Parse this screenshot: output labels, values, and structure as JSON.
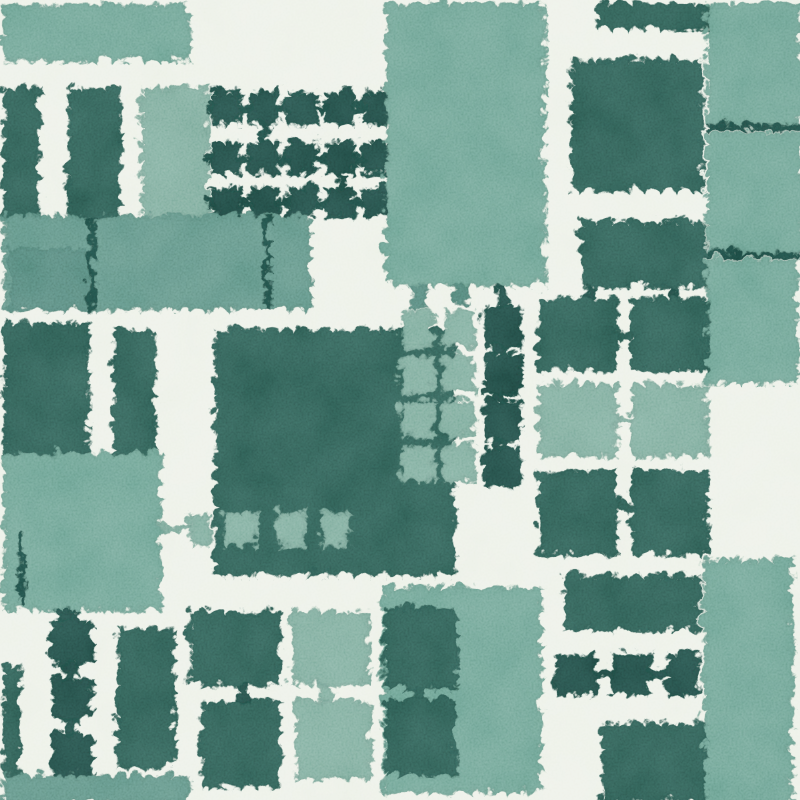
{
  "scene": {
    "type": "abstract-watercolor-block-pattern",
    "width": 800,
    "height": 800,
    "background": "#edf1e8"
  },
  "palette": {
    "paper": "#edf1e8",
    "tealA": "#6da293",
    "tealB": "#7cab9c",
    "tealC": "#5f9285",
    "tealD": "#538579",
    "green": "#2e5c53",
    "greenDark": "#214b45"
  },
  "shapes": [
    {
      "name": "top-band",
      "x": 0,
      "y": 0,
      "w": 186,
      "h": 58,
      "c": "tealA"
    },
    {
      "name": "teal-col-top",
      "x": 138,
      "y": 84,
      "w": 68,
      "h": 130,
      "c": "tealB"
    },
    {
      "name": "dark-col-a",
      "x": 0,
      "y": 84,
      "w": 38,
      "h": 130,
      "c": "green"
    },
    {
      "name": "dark-col-b",
      "x": 64,
      "y": 84,
      "w": 54,
      "h": 130,
      "c": "green"
    },
    {
      "name": "grid-a-sq",
      "x": 208,
      "y": 88,
      "w": 30,
      "h": 33,
      "c": "greenDark"
    },
    {
      "name": "grid-a-sq",
      "x": 246,
      "y": 88,
      "w": 30,
      "h": 33,
      "c": "greenDark"
    },
    {
      "name": "grid-a-sq",
      "x": 284,
      "y": 88,
      "w": 30,
      "h": 33,
      "c": "greenDark"
    },
    {
      "name": "grid-a-sq",
      "x": 322,
      "y": 88,
      "w": 30,
      "h": 33,
      "c": "greenDark"
    },
    {
      "name": "grid-a-sq",
      "x": 360,
      "y": 88,
      "w": 30,
      "h": 33,
      "c": "greenDark"
    },
    {
      "name": "grid-a-sq",
      "x": 208,
      "y": 138,
      "w": 30,
      "h": 34,
      "c": "greenDark"
    },
    {
      "name": "grid-a-sq",
      "x": 246,
      "y": 138,
      "w": 30,
      "h": 34,
      "c": "greenDark"
    },
    {
      "name": "grid-a-sq",
      "x": 284,
      "y": 138,
      "w": 30,
      "h": 34,
      "c": "greenDark"
    },
    {
      "name": "grid-a-sq",
      "x": 322,
      "y": 138,
      "w": 30,
      "h": 34,
      "c": "greenDark"
    },
    {
      "name": "grid-a-sq",
      "x": 360,
      "y": 138,
      "w": 30,
      "h": 34,
      "c": "greenDark"
    },
    {
      "name": "grid-a-sq",
      "x": 208,
      "y": 184,
      "w": 30,
      "h": 30,
      "c": "greenDark"
    },
    {
      "name": "grid-a-sq",
      "x": 246,
      "y": 184,
      "w": 30,
      "h": 30,
      "c": "greenDark"
    },
    {
      "name": "grid-a-sq",
      "x": 284,
      "y": 184,
      "w": 30,
      "h": 30,
      "c": "greenDark"
    },
    {
      "name": "grid-a-sq",
      "x": 322,
      "y": 184,
      "w": 30,
      "h": 30,
      "c": "greenDark"
    },
    {
      "name": "grid-a-sq",
      "x": 360,
      "y": 184,
      "w": 30,
      "h": 30,
      "c": "greenDark"
    },
    {
      "name": "grid-a-link",
      "x": 238,
      "y": 101,
      "w": 8,
      "h": 9,
      "c": "greenDark"
    },
    {
      "name": "grid-a-link",
      "x": 276,
      "y": 101,
      "w": 8,
      "h": 9,
      "c": "greenDark"
    },
    {
      "name": "grid-a-link",
      "x": 314,
      "y": 101,
      "w": 8,
      "h": 9,
      "c": "greenDark"
    },
    {
      "name": "grid-a-link",
      "x": 352,
      "y": 101,
      "w": 8,
      "h": 9,
      "c": "greenDark"
    },
    {
      "name": "grid-a-link",
      "x": 238,
      "y": 152,
      "w": 8,
      "h": 9,
      "c": "greenDark"
    },
    {
      "name": "grid-a-link",
      "x": 276,
      "y": 152,
      "w": 8,
      "h": 9,
      "c": "greenDark"
    },
    {
      "name": "grid-a-link",
      "x": 314,
      "y": 152,
      "w": 8,
      "h": 9,
      "c": "greenDark"
    },
    {
      "name": "grid-a-link",
      "x": 352,
      "y": 152,
      "w": 8,
      "h": 9,
      "c": "greenDark"
    },
    {
      "name": "grid-a-link",
      "x": 238,
      "y": 195,
      "w": 8,
      "h": 9,
      "c": "greenDark"
    },
    {
      "name": "grid-a-link",
      "x": 276,
      "y": 195,
      "w": 8,
      "h": 9,
      "c": "greenDark"
    },
    {
      "name": "grid-a-link",
      "x": 314,
      "y": 195,
      "w": 8,
      "h": 9,
      "c": "greenDark"
    },
    {
      "name": "grid-a-link",
      "x": 352,
      "y": 195,
      "w": 8,
      "h": 9,
      "c": "greenDark"
    },
    {
      "name": "grid-a-stub",
      "x": 202,
      "y": 100,
      "w": 8,
      "h": 10,
      "c": "greenDark"
    },
    {
      "name": "grid-a-stub",
      "x": 202,
      "y": 150,
      "w": 8,
      "h": 10,
      "c": "greenDark"
    },
    {
      "name": "grid-a-stub",
      "x": 202,
      "y": 194,
      "w": 8,
      "h": 10,
      "c": "greenDark"
    },
    {
      "name": "grid-a-vlink",
      "x": 258,
      "y": 121,
      "w": 8,
      "h": 17,
      "c": "greenDark"
    },
    {
      "name": "grid-a-vlink",
      "x": 334,
      "y": 172,
      "w": 8,
      "h": 12,
      "c": "greenDark"
    },
    {
      "name": "band-main",
      "x": 0,
      "y": 212,
      "w": 308,
      "h": 95,
      "c": "tealC"
    },
    {
      "name": "band-sub",
      "x": 6,
      "y": 246,
      "w": 84,
      "h": 61,
      "c": "tealD"
    },
    {
      "name": "wire-a",
      "x": 86,
      "y": 212,
      "w": 6,
      "h": 95,
      "c": "greenDark"
    },
    {
      "name": "wire-b",
      "x": 261,
      "y": 214,
      "w": 6,
      "h": 93,
      "c": "greenDark"
    },
    {
      "name": "top-column",
      "x": 382,
      "y": 0,
      "w": 160,
      "h": 282,
      "c": "tealA"
    },
    {
      "name": "column-stub",
      "x": 408,
      "y": 281,
      "w": 16,
      "h": 26,
      "c": "tealD"
    },
    {
      "name": "column-stub",
      "x": 450,
      "y": 281,
      "w": 14,
      "h": 22,
      "c": "tealD"
    },
    {
      "name": "column-stub-dark",
      "x": 492,
      "y": 281,
      "w": 14,
      "h": 24,
      "c": "greenDark"
    },
    {
      "name": "top-dark-rect",
      "x": 595,
      "y": 0,
      "w": 108,
      "h": 26,
      "c": "green"
    },
    {
      "name": "top-dark-square",
      "x": 568,
      "y": 56,
      "w": 132,
      "h": 132,
      "c": "green"
    },
    {
      "name": "right-col-seg",
      "x": 703,
      "y": 0,
      "w": 97,
      "h": 121,
      "c": "tealA"
    },
    {
      "name": "right-col-seg",
      "x": 703,
      "y": 128,
      "w": 97,
      "h": 121,
      "c": "tealA"
    },
    {
      "name": "right-col-seam",
      "x": 703,
      "y": 120,
      "w": 97,
      "h": 7,
      "c": "greenDark"
    },
    {
      "name": "right-col-seg",
      "x": 702,
      "y": 256,
      "w": 94,
      "h": 124,
      "c": "tealA"
    },
    {
      "name": "right-col-seam",
      "x": 702,
      "y": 249,
      "w": 94,
      "h": 6,
      "c": "greenDark"
    },
    {
      "name": "mid-dark-rect",
      "x": 578,
      "y": 218,
      "w": 124,
      "h": 66,
      "c": "green"
    },
    {
      "name": "mid-rect-stub",
      "x": 582,
      "y": 284,
      "w": 10,
      "h": 12,
      "c": "greenDark"
    },
    {
      "name": "mid-rect-stub",
      "x": 664,
      "y": 284,
      "w": 10,
      "h": 12,
      "c": "greenDark"
    },
    {
      "name": "grid-b-sq",
      "x": 535,
      "y": 295,
      "w": 80,
      "h": 73,
      "c": "green"
    },
    {
      "name": "grid-b-sq",
      "x": 628,
      "y": 295,
      "w": 77,
      "h": 73,
      "c": "green"
    },
    {
      "name": "grid-b-sq",
      "x": 535,
      "y": 381,
      "w": 80,
      "h": 73,
      "c": "tealB"
    },
    {
      "name": "grid-b-sq",
      "x": 628,
      "y": 381,
      "w": 77,
      "h": 73,
      "c": "tealB"
    },
    {
      "name": "grid-b-sq",
      "x": 535,
      "y": 467,
      "w": 80,
      "h": 85,
      "c": "green"
    },
    {
      "name": "grid-b-sq",
      "x": 628,
      "y": 467,
      "w": 77,
      "h": 85,
      "c": "green"
    },
    {
      "name": "grid-b-link",
      "x": 615,
      "y": 327,
      "w": 13,
      "h": 9,
      "c": "green"
    },
    {
      "name": "grid-b-link",
      "x": 615,
      "y": 413,
      "w": 13,
      "h": 9,
      "c": "tealB"
    },
    {
      "name": "grid-b-link",
      "x": 615,
      "y": 499,
      "w": 13,
      "h": 9,
      "c": "green"
    },
    {
      "name": "center-block",
      "x": 212,
      "y": 326,
      "w": 240,
      "h": 246,
      "c": "green"
    },
    {
      "name": "light-col-sq",
      "x": 398,
      "y": 308,
      "w": 34,
      "h": 37,
      "c": "tealB"
    },
    {
      "name": "light-col-sq",
      "x": 398,
      "y": 352,
      "w": 34,
      "h": 38,
      "c": "tealB"
    },
    {
      "name": "light-col-sq",
      "x": 398,
      "y": 397,
      "w": 34,
      "h": 37,
      "c": "tealB"
    },
    {
      "name": "light-col-sq",
      "x": 398,
      "y": 441,
      "w": 34,
      "h": 37,
      "c": "tealB"
    },
    {
      "name": "light-col-sq",
      "x": 440,
      "y": 308,
      "w": 32,
      "h": 37,
      "c": "tealB"
    },
    {
      "name": "light-col-sq",
      "x": 440,
      "y": 352,
      "w": 32,
      "h": 38,
      "c": "tealB"
    },
    {
      "name": "light-col-sq",
      "x": 440,
      "y": 397,
      "w": 32,
      "h": 37,
      "c": "tealB"
    },
    {
      "name": "light-col-sq",
      "x": 440,
      "y": 441,
      "w": 32,
      "h": 37,
      "c": "tealB"
    },
    {
      "name": "chain-col-sq",
      "x": 480,
      "y": 303,
      "w": 38,
      "h": 42,
      "c": "greenDark"
    },
    {
      "name": "chain-col-sq",
      "x": 480,
      "y": 350,
      "w": 38,
      "h": 42,
      "c": "greenDark"
    },
    {
      "name": "chain-col-sq",
      "x": 480,
      "y": 396,
      "w": 38,
      "h": 42,
      "c": "greenDark"
    },
    {
      "name": "chain-col-sq",
      "x": 480,
      "y": 443,
      "w": 38,
      "h": 40,
      "c": "greenDark"
    },
    {
      "name": "chain-col-vlink",
      "x": 493,
      "y": 341,
      "w": 10,
      "h": 13,
      "c": "greenDark"
    },
    {
      "name": "chain-col-vlink",
      "x": 493,
      "y": 388,
      "w": 10,
      "h": 12,
      "c": "greenDark"
    },
    {
      "name": "chain-col-vlink",
      "x": 493,
      "y": 434,
      "w": 10,
      "h": 13,
      "c": "greenDark"
    },
    {
      "name": "block-chain-sq",
      "x": 220,
      "y": 508,
      "w": 34,
      "h": 36,
      "c": "tealB"
    },
    {
      "name": "block-chain-sq",
      "x": 274,
      "y": 508,
      "w": 28,
      "h": 36,
      "c": "tealB"
    },
    {
      "name": "block-chain-sq",
      "x": 318,
      "y": 508,
      "w": 28,
      "h": 36,
      "c": "tealB"
    },
    {
      "name": "block-chain-sq",
      "x": 185,
      "y": 510,
      "w": 24,
      "h": 31,
      "c": "tealB"
    },
    {
      "name": "block-chain-line",
      "x": 156,
      "y": 522,
      "w": 30,
      "h": 7,
      "c": "tealB"
    },
    {
      "name": "col-a-mid",
      "x": 0,
      "y": 320,
      "w": 86,
      "h": 132,
      "c": "green"
    },
    {
      "name": "col-b-mid",
      "x": 110,
      "y": 326,
      "w": 42,
      "h": 127,
      "c": "green"
    },
    {
      "name": "left-teal-block",
      "x": 0,
      "y": 450,
      "w": 158,
      "h": 157,
      "c": "tealA"
    },
    {
      "name": "left-thin-line",
      "x": 16,
      "y": 532,
      "w": 6,
      "h": 72,
      "c": "greenDark"
    },
    {
      "name": "chain-left-sq",
      "x": 48,
      "y": 618,
      "w": 42,
      "h": 44,
      "c": "greenDark"
    },
    {
      "name": "chain-left-sq",
      "x": 48,
      "y": 674,
      "w": 42,
      "h": 42,
      "c": "greenDark"
    },
    {
      "name": "chain-left-sq",
      "x": 48,
      "y": 730,
      "w": 42,
      "h": 44,
      "c": "greenDark"
    },
    {
      "name": "chain-left-vlink",
      "x": 61,
      "y": 660,
      "w": 13,
      "h": 16,
      "c": "greenDark"
    },
    {
      "name": "chain-left-vlink",
      "x": 61,
      "y": 714,
      "w": 13,
      "h": 18,
      "c": "greenDark"
    },
    {
      "name": "chain-left-stub",
      "x": 54,
      "y": 604,
      "w": 20,
      "h": 16,
      "c": "greenDark"
    },
    {
      "name": "left-strip",
      "x": 0,
      "y": 662,
      "w": 18,
      "h": 114,
      "c": "green"
    },
    {
      "name": "tall-dark-rect",
      "x": 114,
      "y": 626,
      "w": 58,
      "h": 139,
      "c": "green"
    },
    {
      "name": "bottom-band",
      "x": 0,
      "y": 772,
      "w": 186,
      "h": 28,
      "c": "tealC"
    },
    {
      "name": "bottom-dark-rect",
      "x": 186,
      "y": 608,
      "w": 92,
      "h": 74,
      "c": "green"
    },
    {
      "name": "bottom-dark-rect",
      "x": 198,
      "y": 698,
      "w": 80,
      "h": 86,
      "c": "green"
    },
    {
      "name": "bottom-dark-vlink",
      "x": 234,
      "y": 681,
      "w": 14,
      "h": 18,
      "c": "greenDark"
    },
    {
      "name": "bottom-light-sq",
      "x": 288,
      "y": 608,
      "w": 78,
      "h": 74,
      "c": "tealB"
    },
    {
      "name": "bottom-light-sq",
      "x": 292,
      "y": 698,
      "w": 76,
      "h": 78,
      "c": "tealB"
    },
    {
      "name": "bottom-light-vlink",
      "x": 314,
      "y": 681,
      "w": 16,
      "h": 18,
      "c": "tealB"
    },
    {
      "name": "bottom-teal-bg",
      "x": 379,
      "y": 584,
      "w": 160,
      "h": 206,
      "c": "tealA"
    },
    {
      "name": "bottom-teal-dark-sq",
      "x": 381,
      "y": 604,
      "w": 74,
      "h": 82,
      "c": "green"
    },
    {
      "name": "bottom-teal-dark-sq",
      "x": 381,
      "y": 696,
      "w": 72,
      "h": 76,
      "c": "green"
    },
    {
      "name": "bottom-teal-dark-vlink",
      "x": 408,
      "y": 685,
      "w": 16,
      "h": 12,
      "c": "green"
    },
    {
      "name": "br-bar",
      "x": 560,
      "y": 572,
      "w": 138,
      "h": 56,
      "c": "green"
    },
    {
      "name": "br-chain-sq",
      "x": 552,
      "y": 650,
      "w": 42,
      "h": 42,
      "c": "greenDark"
    },
    {
      "name": "br-chain-sq",
      "x": 608,
      "y": 650,
      "w": 40,
      "h": 42,
      "c": "greenDark"
    },
    {
      "name": "br-chain-sq",
      "x": 664,
      "y": 650,
      "w": 32,
      "h": 42,
      "c": "greenDark"
    },
    {
      "name": "br-chain-hlink",
      "x": 592,
      "y": 666,
      "w": 18,
      "h": 10,
      "c": "greenDark"
    },
    {
      "name": "br-chain-hlink",
      "x": 646,
      "y": 666,
      "w": 20,
      "h": 10,
      "c": "greenDark"
    },
    {
      "name": "br-teal-col",
      "x": 700,
      "y": 556,
      "w": 90,
      "h": 244,
      "c": "tealA"
    },
    {
      "name": "br-dark-block",
      "x": 598,
      "y": 720,
      "w": 104,
      "h": 80,
      "c": "green"
    }
  ]
}
